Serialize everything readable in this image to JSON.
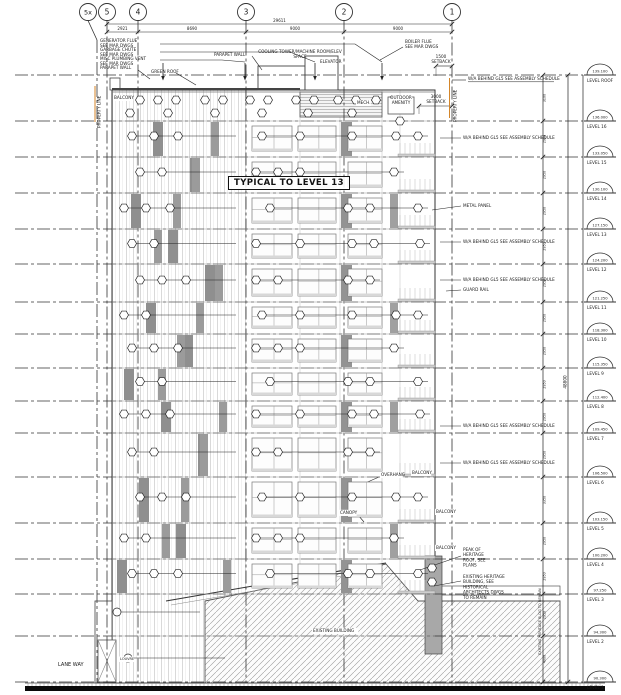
{
  "drawing": {
    "sheet": {
      "width": 621,
      "height": 695
    },
    "boxed_note": "TYPICAL TO LEVEL 13",
    "grids": [
      {
        "label": "5x",
        "x": 88,
        "line_x": 97,
        "elbow": true
      },
      {
        "label": "5",
        "x": 107
      },
      {
        "label": "4",
        "x": 138
      },
      {
        "label": "3",
        "x": 246
      },
      {
        "label": "2",
        "x": 344
      },
      {
        "label": "1",
        "x": 452
      }
    ],
    "top_dims": {
      "overall": "29611",
      "segments": [
        "2921",
        "8690",
        "9000",
        "9000"
      ]
    },
    "height_overall": "48800",
    "levels": [
      {
        "name": "LEVEL ROOF",
        "elev": "139.100",
        "y": 75,
        "dim_below": "3100"
      },
      {
        "name": "LEVEL 16",
        "elev": "136.000",
        "y": 121,
        "dim_below": "2950"
      },
      {
        "name": "LEVEL 15",
        "elev": "133.050",
        "y": 157,
        "dim_below": "2950"
      },
      {
        "name": "LEVEL 14",
        "elev": "130.100",
        "y": 193,
        "dim_below": "2950"
      },
      {
        "name": "LEVEL 13",
        "elev": "127.150",
        "y": 229,
        "dim_below": "2950"
      },
      {
        "name": "LEVEL 12",
        "elev": "124.200",
        "y": 264,
        "dim_below": "2950"
      },
      {
        "name": "LEVEL 11",
        "elev": "121.250",
        "y": 302,
        "dim_below": "2950"
      },
      {
        "name": "LEVEL 10",
        "elev": "118.300",
        "y": 334,
        "dim_below": "2950"
      },
      {
        "name": "LEVEL 9",
        "elev": "115.350",
        "y": 368,
        "dim_below": "2950"
      },
      {
        "name": "LEVEL 8",
        "elev": "112.400",
        "y": 401,
        "dim_below": "2950"
      },
      {
        "name": "LEVEL 7",
        "elev": "109.450",
        "y": 433,
        "dim_below": "2950"
      },
      {
        "name": "LEVEL 6",
        "elev": "106.500",
        "y": 477,
        "dim_below": "3350"
      },
      {
        "name": "LEVEL 5",
        "elev": "103.150",
        "y": 523,
        "dim_below": "2950"
      },
      {
        "name": "LEVEL 4",
        "elev": "100.200",
        "y": 559,
        "dim_below": "2950"
      },
      {
        "name": "LEVEL 3",
        "elev": "97.250",
        "y": 594,
        "dim_below": "2950"
      },
      {
        "name": "LEVEL 2",
        "elev": "94.300",
        "y": 636,
        "dim_below": "4000"
      },
      {
        "name": "LEVEL 1",
        "elev": "90.300",
        "y": 682,
        "dim_below": ""
      }
    ],
    "annotations": [
      {
        "t": "GENERATOR FLUE\nSEE MAR DWGS",
        "x": 100,
        "y": 42
      },
      {
        "t": "GARBAGE CHUTE\nSEE MAR DWGS",
        "x": 100,
        "y": 51
      },
      {
        "t": "MISC PLUMBING VENT\nSEE MAR DWGS",
        "x": 100,
        "y": 60
      },
      {
        "t": "PARAPET WALL",
        "x": 100,
        "y": 69
      },
      {
        "t": "GREEN ROOF",
        "x": 151,
        "y": 73
      },
      {
        "t": "PARAPET WALL",
        "x": 214,
        "y": 56
      },
      {
        "t": "COOLING TOWER/MACHINE ROOM/ELEV\nSPACE",
        "x": 300,
        "y": 53,
        "anchor": "middle"
      },
      {
        "t": "ELEVATOR",
        "x": 320,
        "y": 63
      },
      {
        "t": "BOILER FLUE\nSEE MAR DWGS",
        "x": 405,
        "y": 43
      },
      {
        "t": "1500\nSETBACK",
        "x": 441,
        "y": 58,
        "anchor": "middle"
      },
      {
        "t": "3000\nSETBACK",
        "x": 436,
        "y": 98,
        "anchor": "middle"
      },
      {
        "t": "OUTDOOR\nAMENITY",
        "x": 401,
        "y": 99,
        "anchor": "middle",
        "bg": true
      },
      {
        "t": "MECH.",
        "x": 357,
        "y": 104,
        "bg": true
      },
      {
        "t": "BALCONY",
        "x": 114,
        "y": 99,
        "bg": true
      },
      {
        "t": "W/A BEHIND GL5 SEE ASSEMBLY SCHEDULE",
        "x": 468,
        "y": 80,
        "ul": true
      },
      {
        "t": "W/A BEHIND GL5 SEE ASSEMBLY SCHEDULE",
        "x": 463,
        "y": 139
      },
      {
        "t": "METAL PANEL",
        "x": 463,
        "y": 207
      },
      {
        "t": "W/A BEHIND GL5 SEE ASSEMBLY SCHEDULE",
        "x": 463,
        "y": 243
      },
      {
        "t": "W/A BEHIND GL5 SEE ASSEMBLY SCHEDULE",
        "x": 463,
        "y": 281
      },
      {
        "t": "GUARD RAIL",
        "x": 463,
        "y": 291
      },
      {
        "t": "W/A BEHIND GL5 SEE ASSEMBLY SCHEDULE",
        "x": 463,
        "y": 427
      },
      {
        "t": "W/A BEHIND GL5 SEE ASSEMBLY SCHEDULE",
        "x": 463,
        "y": 464
      },
      {
        "t": "OVERHANG",
        "x": 381,
        "y": 476,
        "bg": true
      },
      {
        "t": "CANOPY",
        "x": 340,
        "y": 514,
        "bg": true
      },
      {
        "t": "BALCONY",
        "x": 412,
        "y": 474,
        "bg": true
      },
      {
        "t": "BALCONY",
        "x": 436,
        "y": 513,
        "bg": true
      },
      {
        "t": "BALCONY",
        "x": 436,
        "y": 549,
        "bg": true
      },
      {
        "t": "PEAK OF\nHERITAGE\nROOF, SEE\nPLANS",
        "x": 463,
        "y": 551
      },
      {
        "t": "EXISTING HERITAGE\nBUILDING, SEE\nHISTORICAL\nARCHITECTS DWGS\nTO REMAIN",
        "x": 463,
        "y": 578
      },
      {
        "t": "EXISTING BUILDING",
        "x": 313,
        "y": 632,
        "bg": true
      },
      {
        "t": "LANE WAY",
        "x": 58,
        "y": 666,
        "size": 5
      },
      {
        "t": "LOUVRE",
        "x": 120,
        "y": 660,
        "size": 3.5,
        "bg": true
      },
      {
        "t": "PROPERTY LINE",
        "x": 100.5,
        "y": 128,
        "rot": -90,
        "color": "#2b5fa5"
      },
      {
        "t": "PROPERTY LINE",
        "x": 456.5,
        "y": 122,
        "rot": -90,
        "color": "#2b5fa5"
      },
      {
        "t": "EXISTING HERITAGE BLDG TO REMAIN",
        "x": 541,
        "y": 655,
        "rot": -90,
        "size": 3.5
      }
    ],
    "legend_colors": {
      "property_line_text": "#2b5fa5",
      "setback_line": "#d4862a"
    }
  }
}
